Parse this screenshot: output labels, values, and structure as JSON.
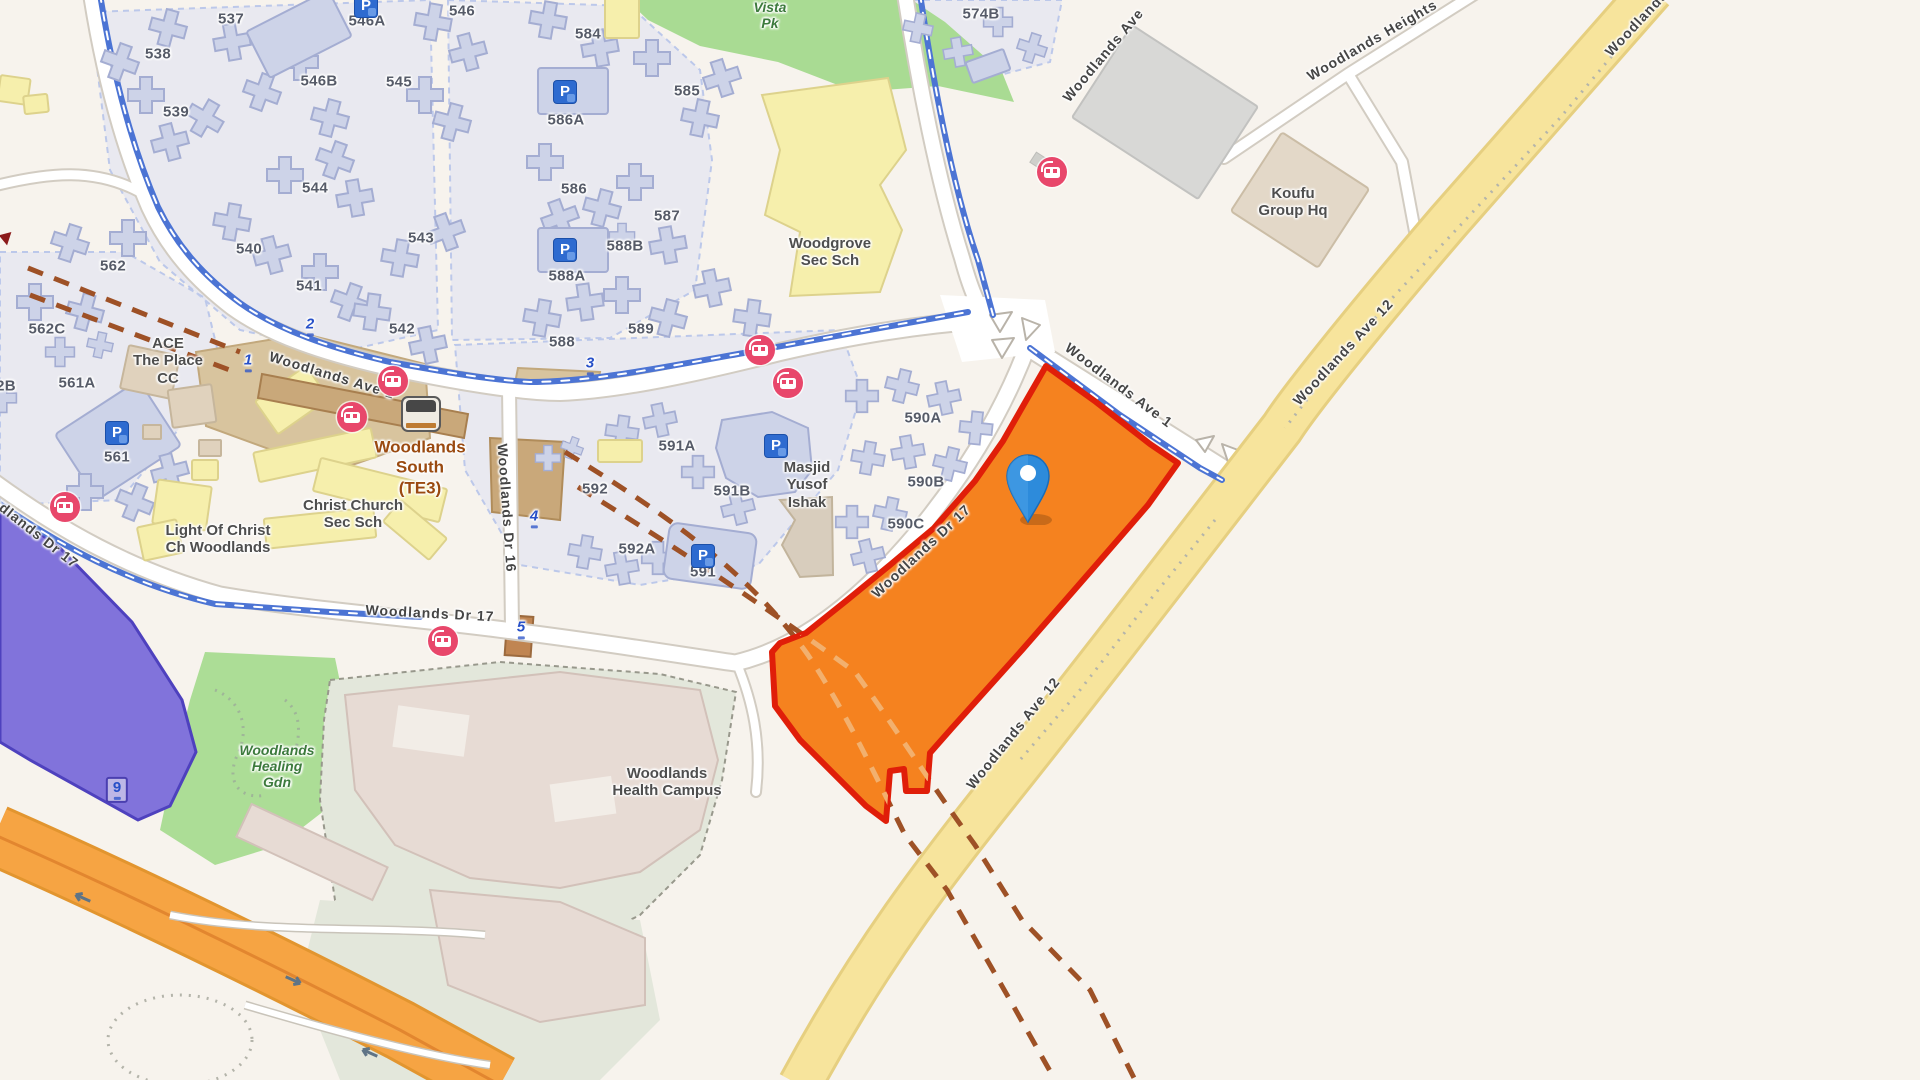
{
  "title": "Woodlands area map with selected site parcel",
  "colors": {
    "land": "#F7F3ED",
    "estateTint": "#E9EDF8",
    "building": "#CDD3E8",
    "buildingStroke": "#A4ADD2",
    "civicYellow": "#F6EFAC",
    "civicYellowStroke": "#DDD28C",
    "parkGreen": "#A9DB93",
    "zonePurple": "#8173DB",
    "zonePurpleStroke": "#4E41BE",
    "parcelOrange": "#F5821F",
    "parcelStroke": "#E01E09",
    "road": "#FFFFFF",
    "roadCasing": "#D2CCC2",
    "highwayYellow": "#F7E49C",
    "highwayCasing": "#E6CF80",
    "motorwayOrange": "#F6A443",
    "motorwayLine": "#E2862F",
    "cycleBlue": "#4C74D4",
    "busPink": "#E8476B",
    "parkBlue": "#2E6BD0",
    "railDashBrown": "#9E5126",
    "railDashOnParcel": "#F2B06E",
    "stationTan": "#C9A87A",
    "worksTan": "#D8C49E",
    "campusGround": "#E3E7DB",
    "campusBldg": "#E7DBD4",
    "labelBlock": "#565B68",
    "labelRoad": "#454545",
    "labelPoi": "#4E4E4E",
    "labelPark": "#3C7A3C",
    "labelTe": "#9A4A10",
    "markerBlue": "#2750C8",
    "pinBlue": "#2D8BDB"
  },
  "map": {
    "block_labels": [
      {
        "text": "537",
        "x": 231,
        "y": 19
      },
      {
        "text": "538",
        "x": 158,
        "y": 54
      },
      {
        "text": "539",
        "x": 176,
        "y": 112
      },
      {
        "text": "540",
        "x": 249,
        "y": 249
      },
      {
        "text": "541",
        "x": 309,
        "y": 286
      },
      {
        "text": "542",
        "x": 402,
        "y": 329
      },
      {
        "text": "543",
        "x": 421,
        "y": 238
      },
      {
        "text": "544",
        "x": 315,
        "y": 188
      },
      {
        "text": "545",
        "x": 399,
        "y": 82
      },
      {
        "text": "546",
        "x": 462,
        "y": 11
      },
      {
        "text": "546A",
        "x": 367,
        "y": 21
      },
      {
        "text": "546B",
        "x": 319,
        "y": 81
      },
      {
        "text": "584",
        "x": 588,
        "y": 34
      },
      {
        "text": "585",
        "x": 687,
        "y": 91
      },
      {
        "text": "586",
        "x": 574,
        "y": 189
      },
      {
        "text": "586A",
        "x": 566,
        "y": 120
      },
      {
        "text": "587",
        "x": 667,
        "y": 216
      },
      {
        "text": "588",
        "x": 562,
        "y": 342
      },
      {
        "text": "588A",
        "x": 567,
        "y": 276
      },
      {
        "text": "588B",
        "x": 625,
        "y": 246
      },
      {
        "text": "589",
        "x": 641,
        "y": 329
      },
      {
        "text": "574B",
        "x": 981,
        "y": 14
      },
      {
        "text": "562",
        "x": 113,
        "y": 266
      },
      {
        "text": "562C",
        "x": 47,
        "y": 329
      },
      {
        "text": "561A",
        "x": 77,
        "y": 383
      },
      {
        "text": "561",
        "x": 117,
        "y": 457
      },
      {
        "text": "2B",
        "x": 6,
        "y": 386
      },
      {
        "text": "590A",
        "x": 923,
        "y": 418
      },
      {
        "text": "590B",
        "x": 926,
        "y": 482
      },
      {
        "text": "590C",
        "x": 906,
        "y": 524
      },
      {
        "text": "591",
        "x": 703,
        "y": 572
      },
      {
        "text": "591A",
        "x": 677,
        "y": 446
      },
      {
        "text": "591B",
        "x": 732,
        "y": 491
      },
      {
        "text": "592",
        "x": 595,
        "y": 489
      },
      {
        "text": "592A",
        "x": 637,
        "y": 549
      }
    ],
    "road_labels": [
      {
        "text": "Woodlands Ave 1",
        "x": 332,
        "y": 375,
        "rotate": 17
      },
      {
        "text": "Woodlands Ave 1",
        "x": 1119,
        "y": 385,
        "rotate": 37
      },
      {
        "text": "Woodlands Ave",
        "x": 1103,
        "y": 55,
        "rotate": -50
      },
      {
        "text": "Woodlands Heights",
        "x": 1372,
        "y": 40,
        "rotate": -30
      },
      {
        "text": "Woodlands Ave 12",
        "x": 1343,
        "y": 352,
        "rotate": -47
      },
      {
        "text": "Woodlands Ave 12",
        "x": 1013,
        "y": 733,
        "rotate": -51
      },
      {
        "text": "Woodlands Ave 12",
        "x": 1655,
        "y": 3,
        "rotate": -47
      },
      {
        "text": "Woodlands Dr 16",
        "x": 507,
        "y": 508,
        "rotate": 86
      },
      {
        "text": "Woodlands Dr 17",
        "x": 26,
        "y": 525,
        "rotate": 38
      },
      {
        "text": "Woodlands Dr 17",
        "x": 430,
        "y": 613,
        "rotate": 3
      },
      {
        "text": "Woodlands Dr 17",
        "x": 921,
        "y": 551,
        "rotate": -43
      }
    ],
    "poi_labels": [
      {
        "text": "Woodgrove\nSec Sch",
        "x": 830,
        "y": 252
      },
      {
        "text": "Christ Church\nSec Sch",
        "x": 353,
        "y": 514
      },
      {
        "text": "Light Of Christ\nCh Woodlands",
        "x": 218,
        "y": 539
      },
      {
        "text": "ACE\nThe Place\nCC",
        "x": 168,
        "y": 361
      },
      {
        "text": "Masjid\nYusof\nIshak",
        "x": 807,
        "y": 485
      },
      {
        "text": "Koufu\nGroup Hq",
        "x": 1293,
        "y": 202
      },
      {
        "text": "Woodlands\nHealth Campus",
        "x": 667,
        "y": 782
      }
    ],
    "park_labels": [
      {
        "text": "Vista\nPk",
        "x": 770,
        "y": 15
      },
      {
        "text": "Woodlands\nHealing\nGdn",
        "x": 277,
        "y": 766
      }
    ],
    "station_label": {
      "text": "Woodlands\nSouth\n(TE3)",
      "x": 420,
      "y": 468
    },
    "route_markers": [
      {
        "text": "1",
        "x": 248,
        "y": 362
      },
      {
        "text": "2",
        "x": 310,
        "y": 326
      },
      {
        "text": "3",
        "x": 590,
        "y": 365
      },
      {
        "text": "4",
        "x": 534,
        "y": 518
      },
      {
        "text": "5",
        "x": 521,
        "y": 629
      },
      {
        "text": "9",
        "x": 117,
        "y": 790,
        "boxed": true
      }
    ],
    "bus_stops": [
      {
        "x": 65,
        "y": 507
      },
      {
        "x": 352,
        "y": 417
      },
      {
        "x": 393,
        "y": 381
      },
      {
        "x": 443,
        "y": 641
      },
      {
        "x": 760,
        "y": 350
      },
      {
        "x": 788,
        "y": 383
      },
      {
        "x": 1052,
        "y": 172
      }
    ],
    "parking_icons": [
      {
        "text": "P",
        "x": 366,
        "y": 6
      },
      {
        "text": "P",
        "x": 565,
        "y": 92
      },
      {
        "text": "P",
        "x": 565,
        "y": 250
      },
      {
        "text": "P",
        "x": 117,
        "y": 433
      },
      {
        "text": "P",
        "x": 703,
        "y": 556
      },
      {
        "text": "P",
        "x": 776,
        "y": 446
      }
    ],
    "train_icon": {
      "x": 421,
      "y": 414
    },
    "pin": {
      "x": 1028,
      "y": 470
    }
  }
}
